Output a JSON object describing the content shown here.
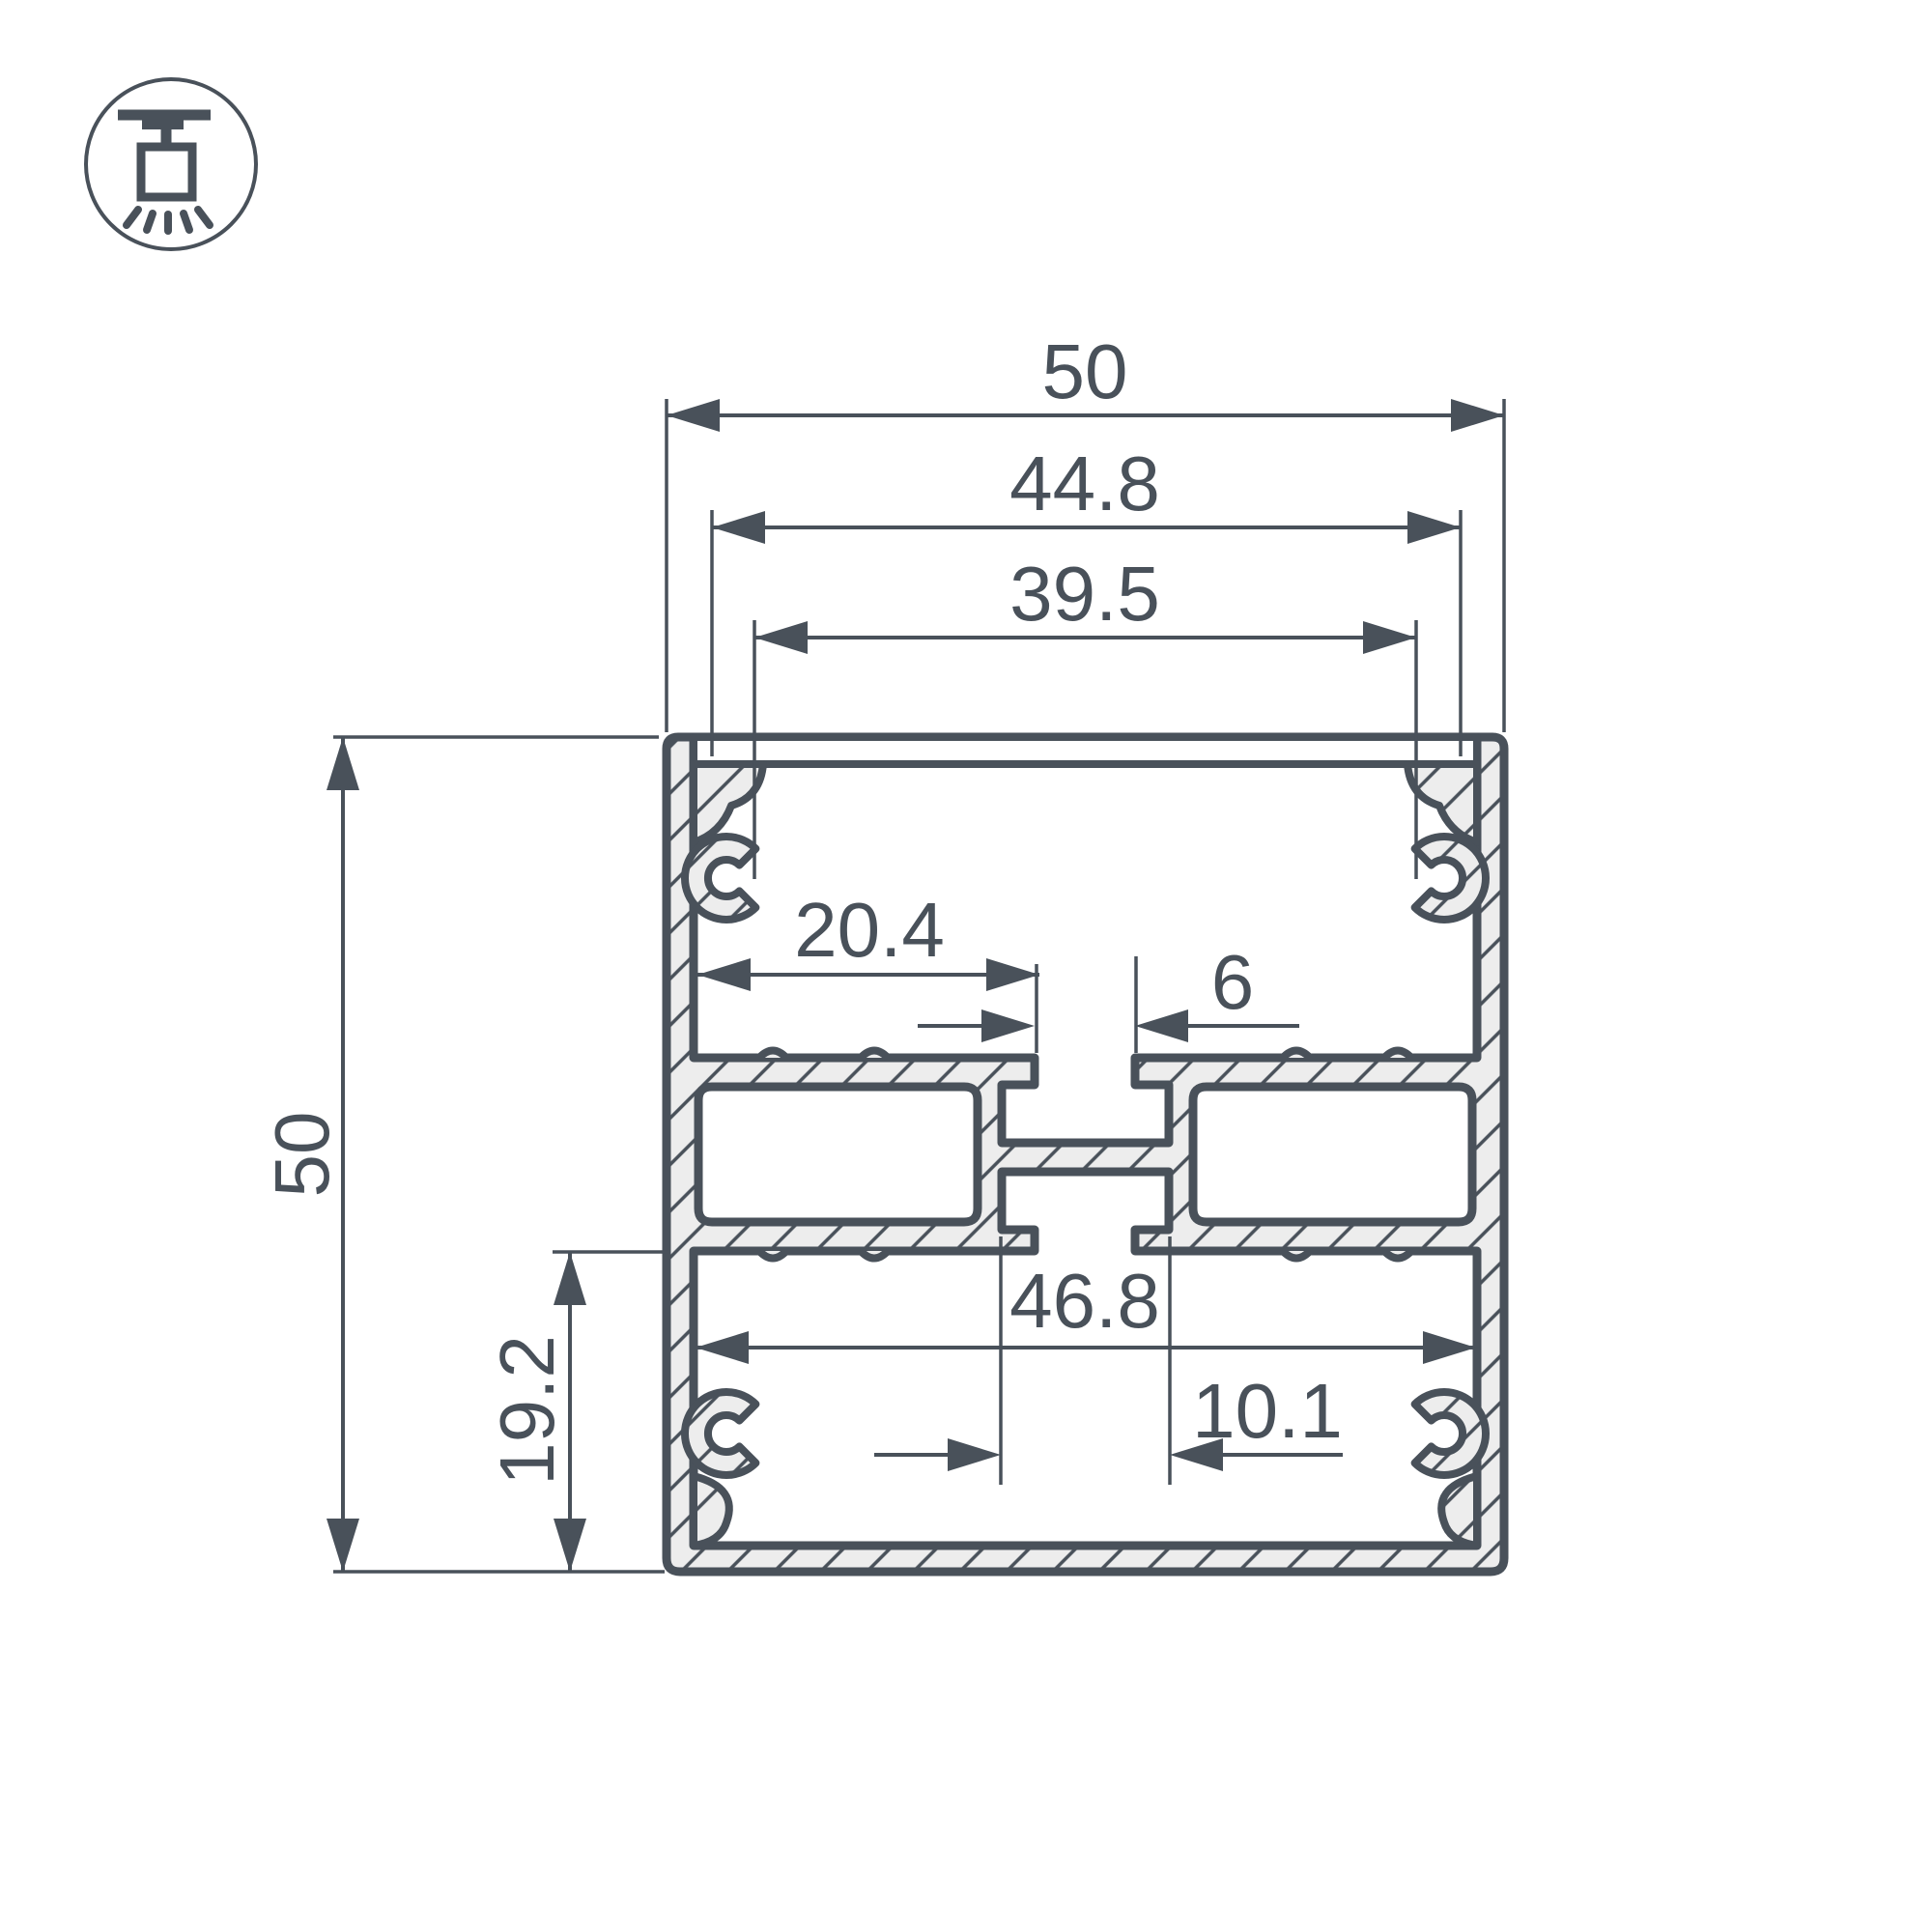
{
  "drawing": {
    "type": "aluminum-led-profile-cross-section",
    "colors": {
      "line": "#49515a",
      "aluminum_fill": "#ededed",
      "background": "#ffffff"
    },
    "icon": {
      "name": "surface-ceiling-mount-light"
    },
    "dimensions": {
      "top_overall_width": "50",
      "cover_width": "44.8",
      "inner_opening_width": "39.5",
      "left_overall_height": "50",
      "shelf_to_slot_width": "20.4",
      "center_slot_width": "6",
      "bottom_inner_width": "46.8",
      "screw_boss_width": "10.1",
      "bottom_chamber_height": "19.2"
    }
  }
}
